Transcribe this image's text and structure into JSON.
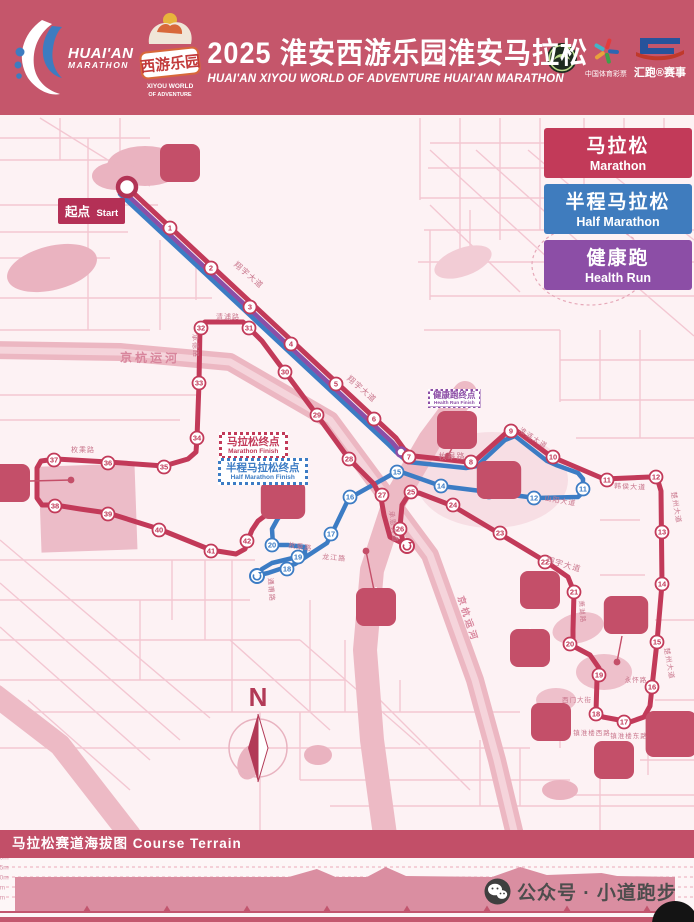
{
  "header": {
    "bg_color": "#c5566b",
    "runner_logo": {
      "line1": "HUAI'AN",
      "line2": "MARATHON"
    },
    "xiyou_logo": {
      "name_cn": "西游乐园",
      "name_en1": "XIYOU WORLD",
      "name_en2": "OF ADVENTURE"
    },
    "title_cn": "2025 淮安西游乐园淮安马拉松",
    "title_en": "HUAI'AN XIYOU WORLD OF ADVENTURE HUAI'AN MARATHON",
    "lottery_label": "中国体育彩票",
    "huipao_label": "汇跑®赛事"
  },
  "legend": [
    {
      "label_cn": "马拉松",
      "label_en": "Marathon",
      "color": "#c23a59"
    },
    {
      "label_cn": "半程马拉松",
      "label_en": "Half Marathon",
      "color": "#3f7cbe"
    },
    {
      "label_cn": "健康跑",
      "label_en": "Health Run",
      "color": "#8c4ea6"
    }
  ],
  "map": {
    "bg_color": "#fdf2f4",
    "route_colors": {
      "marathon": "#c23a59",
      "half": "#3c7cc4",
      "health": "#8c4ea6"
    },
    "start_label": {
      "cn": "起点",
      "en": "Start"
    },
    "finish_boxes": [
      {
        "id": "marathon-finish",
        "cn": "马拉松终点",
        "en": "Marathon Finish"
      },
      {
        "id": "half-marathon-finish",
        "cn": "半程马拉松终点",
        "en": "Half Marathon Finish"
      },
      {
        "id": "health-run-finish",
        "cn": "健康跑终点",
        "en": "Health Run Finish"
      }
    ],
    "markers_red": [
      [
        1,
        170,
        228
      ],
      [
        2,
        211,
        268
      ],
      [
        3,
        250,
        307
      ],
      [
        4,
        291,
        344
      ],
      [
        5,
        336,
        384
      ],
      [
        6,
        374,
        419
      ],
      [
        7,
        409,
        457
      ],
      [
        8,
        471,
        462
      ],
      [
        9,
        511,
        431
      ],
      [
        10,
        553,
        457
      ],
      [
        11,
        607,
        480
      ],
      [
        12,
        656,
        477
      ],
      [
        13,
        662,
        532
      ],
      [
        14,
        662,
        584
      ],
      [
        15,
        657,
        642
      ],
      [
        16,
        652,
        687
      ],
      [
        17,
        624,
        722
      ],
      [
        18,
        596,
        714
      ],
      [
        19,
        599,
        675
      ],
      [
        20,
        570,
        644
      ],
      [
        21,
        574,
        592
      ],
      [
        22,
        545,
        562
      ],
      [
        23,
        500,
        533
      ],
      [
        24,
        453,
        505
      ],
      [
        25,
        411,
        492
      ],
      [
        26,
        400,
        529
      ],
      [
        27,
        382,
        495
      ],
      [
        28,
        349,
        459
      ],
      [
        29,
        317,
        415
      ],
      [
        30,
        285,
        372
      ],
      [
        31,
        249,
        328
      ],
      [
        32,
        201,
        328
      ],
      [
        33,
        199,
        383
      ],
      [
        34,
        197,
        438
      ],
      [
        35,
        164,
        467
      ],
      [
        36,
        108,
        463
      ],
      [
        37,
        54,
        460
      ],
      [
        38,
        55,
        506
      ],
      [
        39,
        108,
        514
      ],
      [
        40,
        159,
        530
      ],
      [
        41,
        211,
        551
      ],
      [
        42,
        247,
        541
      ]
    ],
    "markers_blue": [
      [
        11,
        583,
        489
      ],
      [
        12,
        534,
        498
      ],
      [
        13,
        489,
        492
      ],
      [
        14,
        441,
        486
      ],
      [
        15,
        397,
        472
      ],
      [
        16,
        350,
        497
      ],
      [
        17,
        331,
        534
      ],
      [
        18,
        287,
        569
      ],
      [
        19,
        298,
        557
      ],
      [
        20,
        272,
        545
      ]
    ],
    "road_labels": [
      {
        "text": "翔宇大道",
        "x": 247,
        "y": 277,
        "rot": 41,
        "size": 8
      },
      {
        "text": "翔宇大道",
        "x": 360,
        "y": 391,
        "rot": 41,
        "size": 8
      },
      {
        "text": "翔宇大道",
        "x": 563,
        "y": 567,
        "rot": 16,
        "size": 8
      },
      {
        "text": "京杭运河",
        "x": 150,
        "y": 362,
        "rot": 1,
        "size": 12
      },
      {
        "text": "京杭运河",
        "x": 465,
        "y": 620,
        "rot": 72,
        "size": 9
      },
      {
        "text": "枚皋路",
        "x": 452,
        "y": 459,
        "rot": 0,
        "size": 8
      },
      {
        "text": "枚乘路",
        "x": 83,
        "y": 452,
        "rot": 0,
        "size": 7
      },
      {
        "text": "枚乘路",
        "x": 300,
        "y": 549,
        "rot": 8,
        "size": 7
      },
      {
        "text": "清浦路",
        "x": 228,
        "y": 319,
        "rot": 0,
        "size": 7
      },
      {
        "text": "承德路",
        "x": 193,
        "y": 346,
        "rot": 87,
        "size": 7
      },
      {
        "text": "淮涟大道",
        "x": 532,
        "y": 440,
        "rot": 33,
        "size": 7
      },
      {
        "text": "韩侯大道",
        "x": 630,
        "y": 489,
        "rot": 3,
        "size": 7
      },
      {
        "text": "楚州大道",
        "x": 674,
        "y": 508,
        "rot": 80,
        "size": 7
      },
      {
        "text": "楚州大道",
        "x": 667,
        "y": 664,
        "rot": 80,
        "size": 7
      },
      {
        "text": "山阳大道",
        "x": 560,
        "y": 503,
        "rot": 10,
        "size": 7
      },
      {
        "text": "承恩大道",
        "x": 391,
        "y": 527,
        "rot": 83,
        "size": 7
      },
      {
        "text": "永怀路",
        "x": 636,
        "y": 682,
        "rot": 0,
        "size": 6.5
      },
      {
        "text": "西门大街",
        "x": 577,
        "y": 702,
        "rot": 0,
        "size": 6.5
      },
      {
        "text": "镇淮楼西路",
        "x": 592,
        "y": 735,
        "rot": 0,
        "size": 6.5
      },
      {
        "text": "镇淮楼东路",
        "x": 629,
        "y": 738,
        "rot": 0,
        "size": 6.5
      },
      {
        "text": "龙江路",
        "x": 334,
        "y": 560,
        "rot": 5,
        "size": 7
      },
      {
        "text": "通甫路",
        "x": 269,
        "y": 590,
        "rot": 85,
        "size": 7
      },
      {
        "text": "萧湖路",
        "x": 580,
        "y": 612,
        "rot": 85,
        "size": 6.5
      }
    ],
    "badges": [
      {
        "label": "钵池山公园",
        "x": 180,
        "y": 163,
        "type": "photo"
      },
      {
        "label": "淮安大剧院",
        "x": 457,
        "y": 430,
        "type": "theatre"
      },
      {
        "label": "淮安体育中心",
        "x": 283,
        "y": 500,
        "type": "stadium"
      },
      {
        "label": "淮安森林公园",
        "x": 499,
        "y": 480,
        "type": "forest"
      },
      {
        "label": "淮安电视塔",
        "x": 376,
        "y": 607,
        "type": "tower"
      },
      {
        "label": "河下古镇",
        "x": 540,
        "y": 590,
        "type": "gate"
      },
      {
        "label": "周恩来纪念馆",
        "x": 626,
        "y": 615,
        "type": "building"
      },
      {
        "label": "钓鱼台公园",
        "x": 530,
        "y": 648,
        "type": "pagoda"
      },
      {
        "label": "周恩来故居",
        "x": 551,
        "y": 722,
        "type": "house"
      },
      {
        "label": "镇淮楼",
        "x": 614,
        "y": 760,
        "type": "gate"
      },
      {
        "label": "中国漕运博物馆",
        "x": 671,
        "y": 730,
        "type": "building"
      },
      {
        "label": "淮阴工学院",
        "x": 10,
        "y": 483,
        "type": "gate"
      }
    ],
    "compass_letter": "N"
  },
  "terrain": {
    "title": "马拉松赛道海拔图 Course Terrain",
    "tick_labels": [
      "20m",
      "15m",
      "10m",
      "5m",
      "0m"
    ]
  },
  "watermark": "公众号 · 小道跑步",
  "chart_data": {
    "type": "area",
    "title": "马拉松赛道海拔图 Course Terrain",
    "ylabel_ticks": [
      "20m",
      "15m",
      "10m",
      "5m",
      "0m"
    ],
    "ylim": [
      0,
      20
    ],
    "x_km_range": [
      0,
      42.2
    ],
    "grid": "dashed-horizontal",
    "profile": [
      {
        "km": 0,
        "m": 10
      },
      {
        "km": 17.5,
        "m": 10
      },
      {
        "km": 19.3,
        "m": 14
      },
      {
        "km": 20.5,
        "m": 10
      },
      {
        "km": 22.5,
        "m": 10
      },
      {
        "km": 23.7,
        "m": 15
      },
      {
        "km": 25,
        "m": 10.5
      },
      {
        "km": 30.5,
        "m": 10
      },
      {
        "km": 32.3,
        "m": 15
      },
      {
        "km": 34,
        "m": 11
      },
      {
        "km": 37.5,
        "m": 12
      },
      {
        "km": 38.5,
        "m": 10.5
      },
      {
        "km": 42.2,
        "m": 10
      }
    ]
  }
}
